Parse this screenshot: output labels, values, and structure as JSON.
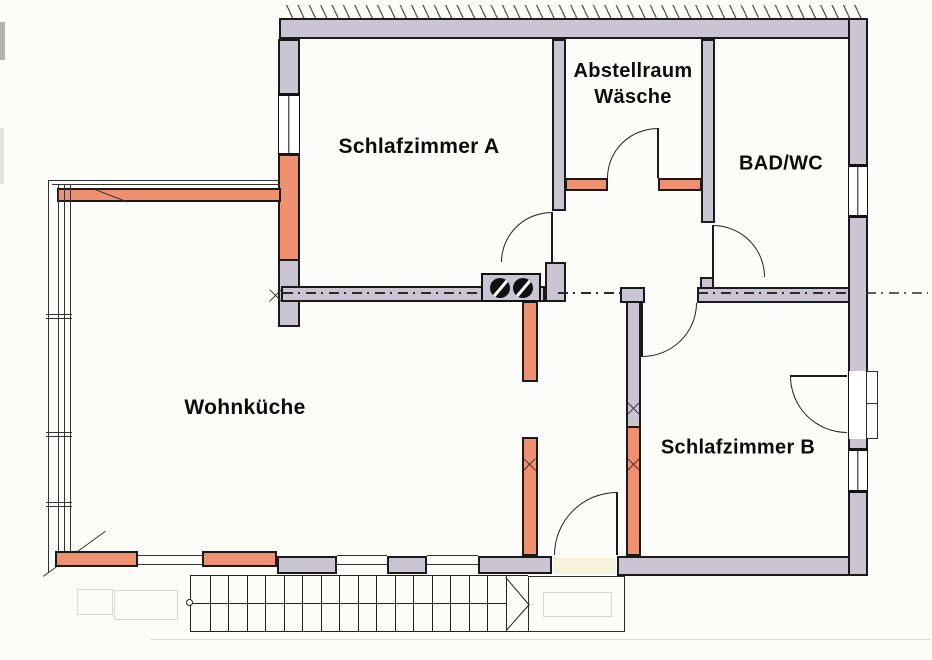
{
  "meta": {
    "type": "residential floor plan scan",
    "language": "de"
  },
  "rooms": {
    "schlafzimmer_a": {
      "label": "Schlafzimmer A"
    },
    "abstellraum": {
      "line1": "Abstellraum",
      "line2": "Wäsche"
    },
    "bad_wc": {
      "label": "BAD/WC"
    },
    "wohnkueche": {
      "label": "Wohnküche"
    },
    "schlafzimmer_b": {
      "label": "Schlafzimmer B"
    }
  },
  "palette": {
    "existing_wall": "#cbc4d2",
    "new_element": "#ef9170",
    "outline": "#1a1a1a",
    "paper": "#fcfcf9",
    "threshold": "#f6f3da"
  },
  "stairs": {
    "step_count": 17
  }
}
